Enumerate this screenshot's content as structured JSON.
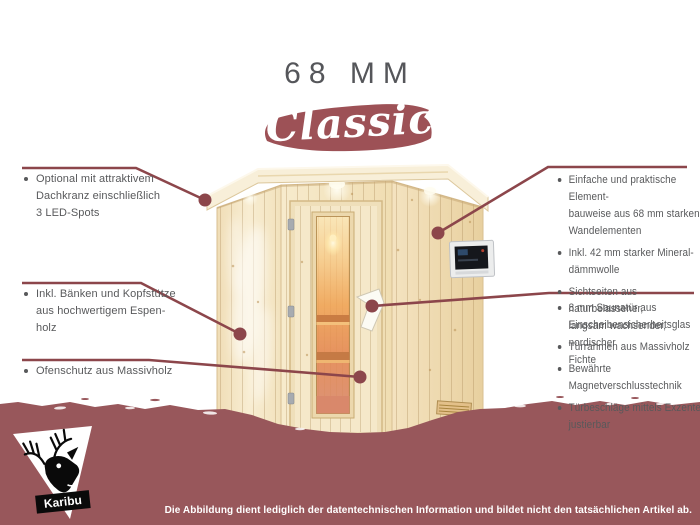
{
  "header": {
    "size_label": "68 MM",
    "series_label": "Classic"
  },
  "colors": {
    "maroon_band": "#98575b",
    "banner_brush": "#9d5156",
    "callout_line": "#8c464b",
    "text_gray": "#58595b",
    "wood_light": "#f6e9cc",
    "glass_glow": "#efa55e",
    "white": "#ffffff"
  },
  "callouts": {
    "left": [
      {
        "lines": [
          "Optional mit attraktivem",
          "Dachkranz einschließlich",
          "3 LED-Spots"
        ]
      },
      {
        "lines": [
          "Inkl. Bänken und Kopfstütze",
          "aus hochwertigem Espen-",
          "holz"
        ]
      },
      {
        "lines": [
          "Ofenschutz aus Massivholz"
        ]
      }
    ],
    "right_top": [
      {
        "lines": [
          "Einfache und praktische Element-",
          "bauweise aus 68 mm starken",
          "Wandelementen"
        ]
      },
      {
        "lines": [
          "Inkl. 42 mm starker Mineral-",
          "dämmwolle"
        ]
      },
      {
        "lines": [
          "Sichtseiten aus naturbelassener,",
          "langsam wachsender, nordischer",
          "Fichte"
        ]
      }
    ],
    "right_bottom": [
      {
        "lines": [
          "8 mm Saunatür aus",
          "Einscheibensicherheitsglas"
        ]
      },
      {
        "lines": [
          "Türrahmen aus Massivholz"
        ]
      },
      {
        "lines": [
          "Bewährte Magnetverschlusstechnik"
        ]
      },
      {
        "lines": [
          "Türbeschläge mittels Exzenter",
          "justierbar"
        ]
      }
    ]
  },
  "illustration": {
    "subject": "corner sauna cabin with glass door, roof crown with LED spots, external control panel"
  },
  "footer": {
    "brand": "Karibu",
    "disclaimer": "Die Abbildung dient lediglich der datentechnischen Information und bildet nicht den tatsächlichen Artikel ab."
  }
}
